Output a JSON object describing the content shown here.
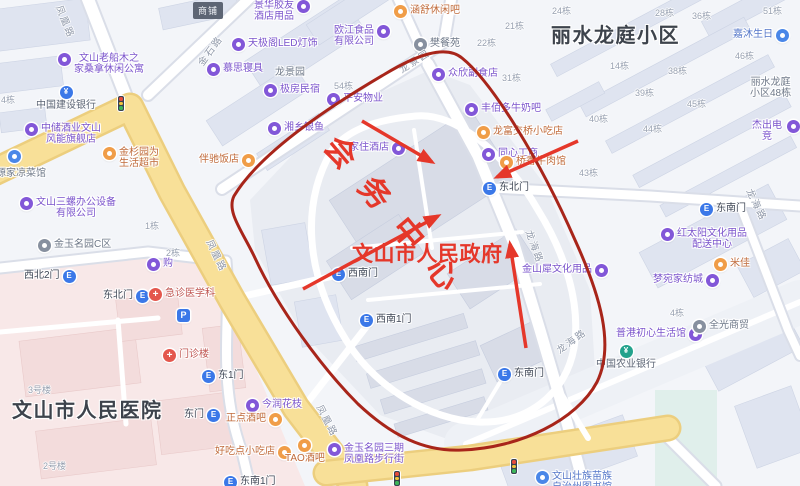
{
  "colors": {
    "red": "#e5372a",
    "darkRed": "#a8251a",
    "purple": "#7b54cc",
    "purpleIcon": "#8257d8",
    "orange": "#c06a3a",
    "orangeIcon": "#f09d48",
    "gray": "#6e7888",
    "grayIcon": "#87909f",
    "gateText": "#3f4756",
    "gateIcon": "#3b78e8",
    "medical": "#bf5450",
    "medicalIcon": "#e4574d",
    "bankText": "#5a6373",
    "ccbIcon": "#3b78e8",
    "abcIcon": "#23a28c",
    "blueText": "#5577c9",
    "blueIcon": "#4a87e8",
    "roadLabel": "#8f98a9",
    "bnum": "#98a1b1",
    "areaText": "#3d434c"
  },
  "overlay": {
    "rotated_label": "会务中心",
    "government_label": "文山市人民政府"
  },
  "area_labels": [
    {
      "name": "residential-district-label",
      "text": "丽水龙庭小区",
      "x": 551,
      "y": 19
    },
    {
      "name": "hospital-label",
      "text": "文山市人民医院",
      "x": 12,
      "y": 394
    }
  ],
  "badge": {
    "text": "商铺",
    "x": 193,
    "y": 2
  },
  "pois": [
    {
      "name": "poi-hotel-supplies",
      "text": "景华胶友\n酒店用品",
      "x": 254,
      "y": 0,
      "kind": "purple",
      "icon": "right"
    },
    {
      "name": "poi-led-lighting",
      "text": "天极阁LED灯饰",
      "x": 232,
      "y": 38,
      "kind": "purple",
      "icon": "left"
    },
    {
      "name": "poi-food-company",
      "text": "欧江食品\n有限公司",
      "x": 334,
      "y": 25,
      "kind": "purple",
      "icon": "right"
    },
    {
      "name": "poi-lounge-bar",
      "text": "涵舒休闲吧",
      "x": 394,
      "y": 5,
      "kind": "orange",
      "icon": "left"
    },
    {
      "name": "poi-restaurant-fan",
      "text": "樊餐苑",
      "x": 414,
      "y": 38,
      "kind": "gray",
      "icon": "left"
    },
    {
      "name": "poi-grocery",
      "text": "众欣副食店",
      "x": 432,
      "y": 68,
      "kind": "purple",
      "icon": "left"
    },
    {
      "name": "poi-milk-bar",
      "text": "丰佰多牛奶吧",
      "x": 465,
      "y": 103,
      "kind": "purple",
      "icon": "left"
    },
    {
      "name": "poi-snack-shop",
      "text": "龙富交桥小吃店",
      "x": 477,
      "y": 126,
      "kind": "orange",
      "icon": "left"
    },
    {
      "name": "poi-tongxin",
      "text": "同心工商",
      "x": 482,
      "y": 148,
      "kind": "purple",
      "icon": "left"
    },
    {
      "name": "poi-beef-restaurant",
      "text": "桥香牛肉馆",
      "x": 500,
      "y": 156,
      "kind": "orange",
      "icon": "left"
    },
    {
      "name": "gate-northeast-compound",
      "text": "东北门",
      "x": 483,
      "y": 182,
      "kind": "gate",
      "icon": "left"
    },
    {
      "name": "poi-jiazhu-hotel",
      "text": "家住酒店",
      "x": 349,
      "y": 142,
      "kind": "purple",
      "icon": "right"
    },
    {
      "name": "poi-homestay",
      "text": "极房民宿",
      "x": 264,
      "y": 84,
      "kind": "purple",
      "icon": "left"
    },
    {
      "name": "poi-property",
      "text": "平安物业",
      "x": 327,
      "y": 93,
      "kind": "purple",
      "icon": "left"
    },
    {
      "name": "poi-silverfish",
      "text": "湘乡银鱼",
      "x": 268,
      "y": 122,
      "kind": "purple",
      "icon": "left"
    },
    {
      "name": "poi-mattress",
      "text": "慕思寝具",
      "x": 207,
      "y": 63,
      "kind": "purple",
      "icon": "left"
    },
    {
      "name": "area-longjingyuan",
      "text": "龙景园",
      "x": 275,
      "y": 67,
      "kind": "gray",
      "icon": "none"
    },
    {
      "name": "poi-sauna-apartment",
      "text": "文山老船木之\n家桑拿休闲公寓",
      "x": 58,
      "y": 53,
      "kind": "purple",
      "icon": "left"
    },
    {
      "name": "poi-ccb-bank",
      "text": "中国建设银行",
      "x": 36,
      "y": 86,
      "kind": "ccb",
      "icon": "above"
    },
    {
      "name": "poi-liquor-store",
      "text": "中储酒业文山\n风能旗舰店",
      "x": 25,
      "y": 123,
      "kind": "purple",
      "icon": "left"
    },
    {
      "name": "poi-supermarket",
      "text": "金杉园为\n生活超市",
      "x": 103,
      "y": 147,
      "kind": "orange",
      "icon": "left"
    },
    {
      "name": "poi-banchi-restaurant",
      "text": "伴驰饭店",
      "x": 199,
      "y": 154,
      "kind": "orange",
      "icon": "right"
    },
    {
      "name": "poi-cold-dish",
      "text": "食源家凉菜馆",
      "x": -14,
      "y": 168,
      "kind": "gray",
      "icon": "none"
    },
    {
      "name": "poi-office-equipment",
      "text": "文山三螺办公设备\n有限公司",
      "x": 20,
      "y": 197,
      "kind": "purple",
      "icon": "left"
    },
    {
      "name": "area-jinyu-c",
      "text": "金玉名园C区",
      "x": 38,
      "y": 239,
      "kind": "gray",
      "icon": "left"
    },
    {
      "name": "gate-northwest-2",
      "text": "西北2门",
      "x": 24,
      "y": 270,
      "kind": "gate",
      "icon": "right"
    },
    {
      "name": "gate-northeast-hospital",
      "text": "东北门",
      "x": 103,
      "y": 290,
      "kind": "gate",
      "icon": "right"
    },
    {
      "name": "poi-emergency-dept",
      "text": "急诊医学科",
      "x": 149,
      "y": 288,
      "kind": "medical",
      "icon": "left"
    },
    {
      "name": "parking-marker",
      "text": "",
      "x": 177,
      "y": 309,
      "kind": "parking",
      "icon": "only"
    },
    {
      "name": "poi-outpatient-building",
      "text": "门诊楼",
      "x": 163,
      "y": 349,
      "kind": "medical",
      "icon": "left"
    },
    {
      "name": "gate-east-1",
      "text": "东1门",
      "x": 202,
      "y": 370,
      "kind": "gate",
      "icon": "left"
    },
    {
      "name": "gate-east",
      "text": "东门",
      "x": 184,
      "y": 409,
      "kind": "gate",
      "icon": "right"
    },
    {
      "name": "poi-flower-shop",
      "text": "今润花枝",
      "x": 246,
      "y": 399,
      "kind": "purple",
      "icon": "left"
    },
    {
      "name": "poi-bar-zhengdian",
      "text": "正点酒吧",
      "x": 226,
      "y": 413,
      "kind": "orange",
      "icon": "right"
    },
    {
      "name": "poi-snack-haochidian",
      "text": "好吃点小吃店",
      "x": 215,
      "y": 446,
      "kind": "orange",
      "icon": "right"
    },
    {
      "name": "poi-tao-bar",
      "text": "TAO酒吧",
      "x": 285,
      "y": 439,
      "kind": "orange",
      "icon": "above"
    },
    {
      "name": "gate-southeast-1",
      "text": "东南1门",
      "x": 224,
      "y": 476,
      "kind": "gate",
      "icon": "left"
    },
    {
      "name": "poi-pedestrian-street",
      "text": "金玉名园三期\n凤凰路步行街",
      "x": 328,
      "y": 443,
      "kind": "purple",
      "icon": "left"
    },
    {
      "name": "gate-southwest",
      "text": "西南门",
      "x": 332,
      "y": 268,
      "kind": "gate",
      "icon": "left"
    },
    {
      "name": "gate-southwest-1",
      "text": "西南1门",
      "x": 360,
      "y": 314,
      "kind": "gate",
      "icon": "left"
    },
    {
      "name": "gate-southeast-compound",
      "text": "东南门",
      "x": 498,
      "y": 368,
      "kind": "gate",
      "icon": "left"
    },
    {
      "name": "poi-abc-bank",
      "text": "中国农业银行",
      "x": 596,
      "y": 345,
      "kind": "abc",
      "icon": "above"
    },
    {
      "name": "poi-lifestyle-shop",
      "text": "普港初心生活馆",
      "x": 616,
      "y": 328,
      "kind": "purple",
      "icon": "right"
    },
    {
      "name": "poi-quanguang",
      "text": "全光商贸",
      "x": 693,
      "y": 320,
      "kind": "gray",
      "icon": "left"
    },
    {
      "name": "poi-library",
      "text": "文山壮族苗族\n自治州图书馆",
      "x": 536,
      "y": 471,
      "kind": "blue",
      "icon": "left"
    },
    {
      "name": "poi-stationery-jinshanxi",
      "text": "金山犀文化用品",
      "x": 522,
      "y": 264,
      "kind": "purple",
      "icon": "right"
    },
    {
      "name": "poi-stationery-distribution",
      "text": "红太阳文化用品\n配送中心",
      "x": 661,
      "y": 228,
      "kind": "purple",
      "icon": "left"
    },
    {
      "name": "poi-home-textiles",
      "text": "梦宛家纺城",
      "x": 653,
      "y": 274,
      "kind": "purple",
      "icon": "right"
    },
    {
      "name": "poi-mijia",
      "text": "米佳",
      "x": 714,
      "y": 258,
      "kind": "orange",
      "icon": "left"
    },
    {
      "name": "gate-southeast-district",
      "text": "东南门",
      "x": 700,
      "y": 203,
      "kind": "gate",
      "icon": "left"
    },
    {
      "name": "poi-birthday-shop",
      "text": "嘉沐生日",
      "x": 733,
      "y": 29,
      "kind": "blue",
      "icon": "right"
    },
    {
      "name": "area-lishui-48",
      "text": "丽水龙庭\n小区48栋",
      "x": 750,
      "y": 77,
      "kind": "gray",
      "icon": "none"
    },
    {
      "name": "poi-esports",
      "text": "杰出电竞",
      "x": 750,
      "y": 120,
      "kind": "purple",
      "icon": "right"
    },
    {
      "name": "poi-shop-gou",
      "text": "购",
      "x": 147,
      "y": 258,
      "kind": "purple",
      "icon": "left"
    },
    {
      "name": "poi-blue-dot",
      "text": "",
      "x": 8,
      "y": 150,
      "kind": "blue",
      "icon": "only"
    }
  ],
  "building_numbers": [
    {
      "text": "24栋",
      "x": 552,
      "y": 4
    },
    {
      "text": "28栋",
      "x": 655,
      "y": 6
    },
    {
      "text": "36栋",
      "x": 692,
      "y": 9
    },
    {
      "text": "51栋",
      "x": 763,
      "y": 4
    },
    {
      "text": "21栋",
      "x": 505,
      "y": 19
    },
    {
      "text": "22栋",
      "x": 477,
      "y": 36
    },
    {
      "text": "31栋",
      "x": 502,
      "y": 71
    },
    {
      "text": "46栋",
      "x": 735,
      "y": 49
    },
    {
      "text": "14栋",
      "x": 610,
      "y": 59
    },
    {
      "text": "38栋",
      "x": 668,
      "y": 64
    },
    {
      "text": "39栋",
      "x": 635,
      "y": 86
    },
    {
      "text": "45栋",
      "x": 687,
      "y": 97
    },
    {
      "text": "40栋",
      "x": 589,
      "y": 112
    },
    {
      "text": "44栋",
      "x": 643,
      "y": 122
    },
    {
      "text": "43栋",
      "x": 579,
      "y": 166
    },
    {
      "text": "54栋",
      "x": 334,
      "y": 79
    },
    {
      "text": "4栋",
      "x": 670,
      "y": 306
    },
    {
      "text": "1栋",
      "x": 145,
      "y": 219
    },
    {
      "text": "2栋",
      "x": 166,
      "y": 246
    },
    {
      "text": "4栋",
      "x": 1,
      "y": 93
    },
    {
      "text": "3号楼",
      "x": 28,
      "y": 383
    },
    {
      "text": "2号楼",
      "x": 43,
      "y": 459
    }
  ],
  "road_labels": [
    {
      "text": "金石路",
      "x": 194,
      "y": 60,
      "rot": -54
    },
    {
      "text": "凤凰路",
      "x": 66,
      "y": 3,
      "rot": 68
    },
    {
      "text": "龙景园",
      "x": 396,
      "y": 64,
      "rot": -33
    },
    {
      "text": "凤凰路",
      "x": 216,
      "y": 237,
      "rot": 64
    },
    {
      "text": "凤凰路",
      "x": 326,
      "y": 402,
      "rot": 62
    },
    {
      "text": "龙海路",
      "x": 536,
      "y": 228,
      "rot": 70
    },
    {
      "text": "龙海路",
      "x": 553,
      "y": 345,
      "rot": -36
    },
    {
      "text": "龙海路",
      "x": 756,
      "y": 186,
      "rot": 64
    }
  ],
  "traffic_lights": [
    {
      "x": 117,
      "y": 95
    },
    {
      "x": 393,
      "y": 470
    },
    {
      "x": 510,
      "y": 458
    }
  ]
}
